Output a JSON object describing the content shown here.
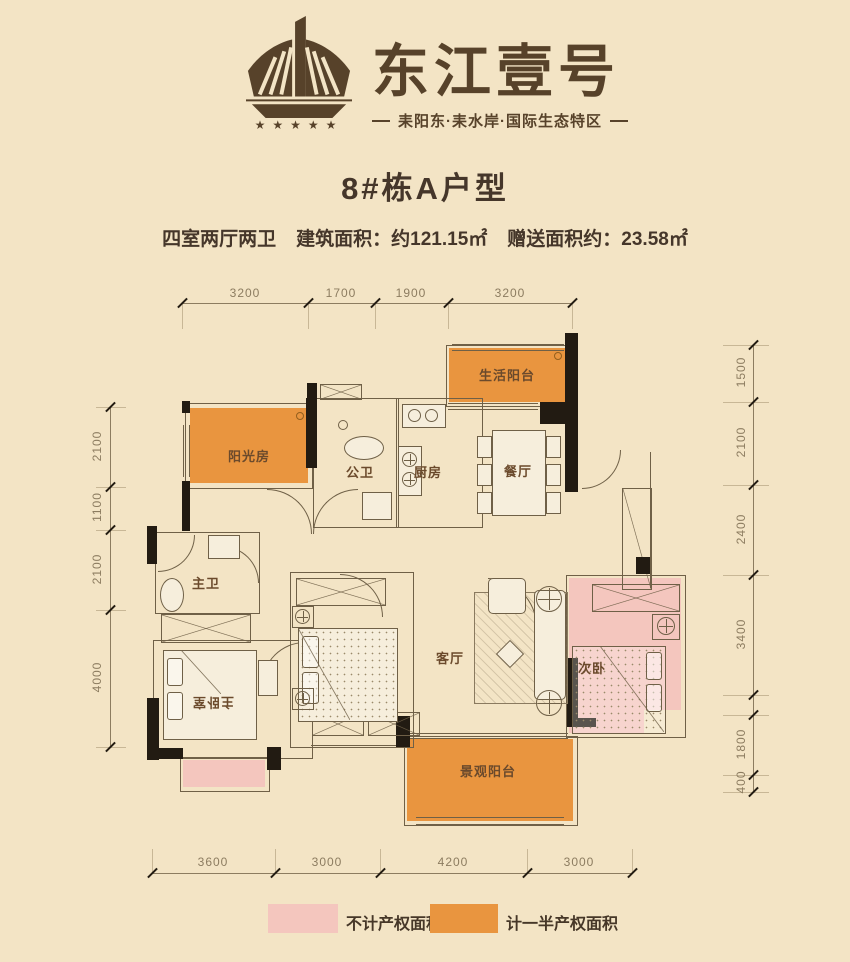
{
  "header": {
    "brand": "东江壹号",
    "tagline": "耒阳东·耒水岸·国际生态特区",
    "stars": "★★★★★"
  },
  "page": {
    "title": "8#栋A户型",
    "spec_rooms": "四室两厅两卫",
    "spec_area": "建筑面积：约121.15㎡",
    "spec_gift": "赠送面积约：23.58㎡"
  },
  "rooms": {
    "sunroom": "阳光房",
    "guest_bath": "公卫",
    "kitchen": "厨房",
    "dining": "餐厅",
    "service_balcony": "生活阳台",
    "master_bath": "主卫",
    "master_bedroom": "主卧室",
    "living": "客厅",
    "second_bedroom": "次卧",
    "view_balcony": "景观阳台"
  },
  "dimensions": {
    "top": [
      "3200",
      "1700",
      "1900",
      "3200"
    ],
    "bottom": [
      "3600",
      "3000",
      "4200",
      "3000"
    ],
    "left": [
      "2100",
      "1100",
      "2100",
      "4000"
    ],
    "right": [
      "1500",
      "2100",
      "2400",
      "3400",
      "1800",
      "400"
    ]
  },
  "legend": [
    {
      "label": "不计产权面积",
      "color": "#F4C6BE"
    },
    {
      "label": "计一半产权面积",
      "color": "#E9953F"
    }
  ],
  "colors": {
    "background": "#F3E4C5",
    "orange": "#E9953F",
    "pink": "#F4C6BE",
    "wall": "#221B12",
    "line": "#6F6047",
    "brand_brown": "#57422A"
  }
}
